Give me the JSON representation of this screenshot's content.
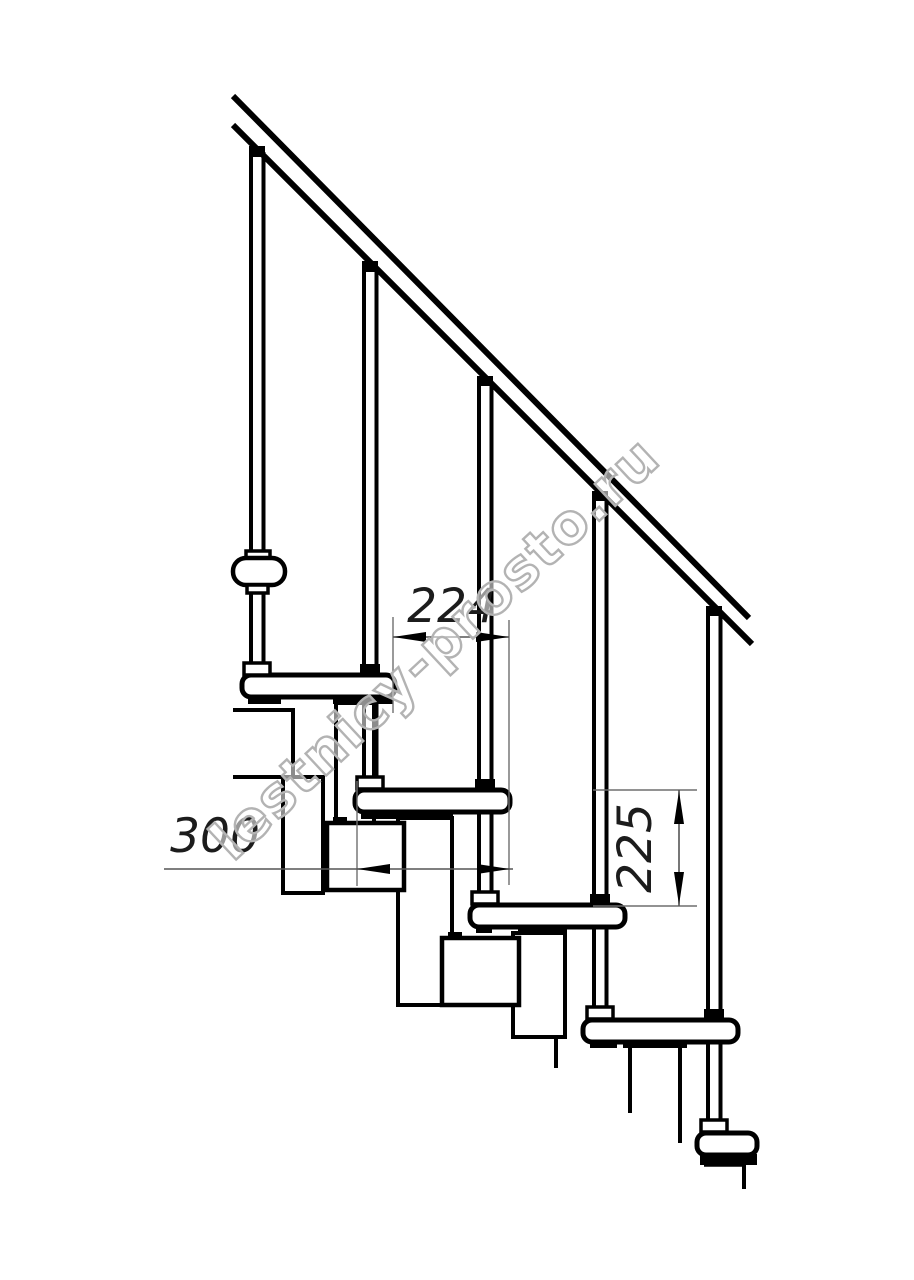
{
  "page": {
    "background": "#ffffff"
  },
  "drawing": {
    "type": "staircase-side-view-technical-drawing",
    "stroke_color": "#000000",
    "dimension_color": "#6e6e6e",
    "treads_count": 5,
    "balusters_count": 5,
    "handrail": "diagonal-45deg"
  },
  "dimensions": {
    "going": {
      "value": "224",
      "orientation": "horizontal"
    },
    "tread_depth": {
      "value": "300",
      "orientation": "horizontal"
    },
    "riser_height": {
      "value": "225",
      "orientation": "vertical"
    }
  },
  "watermark": {
    "text": "lestnicy-prosto.ru",
    "color": "#b3b3b3"
  }
}
